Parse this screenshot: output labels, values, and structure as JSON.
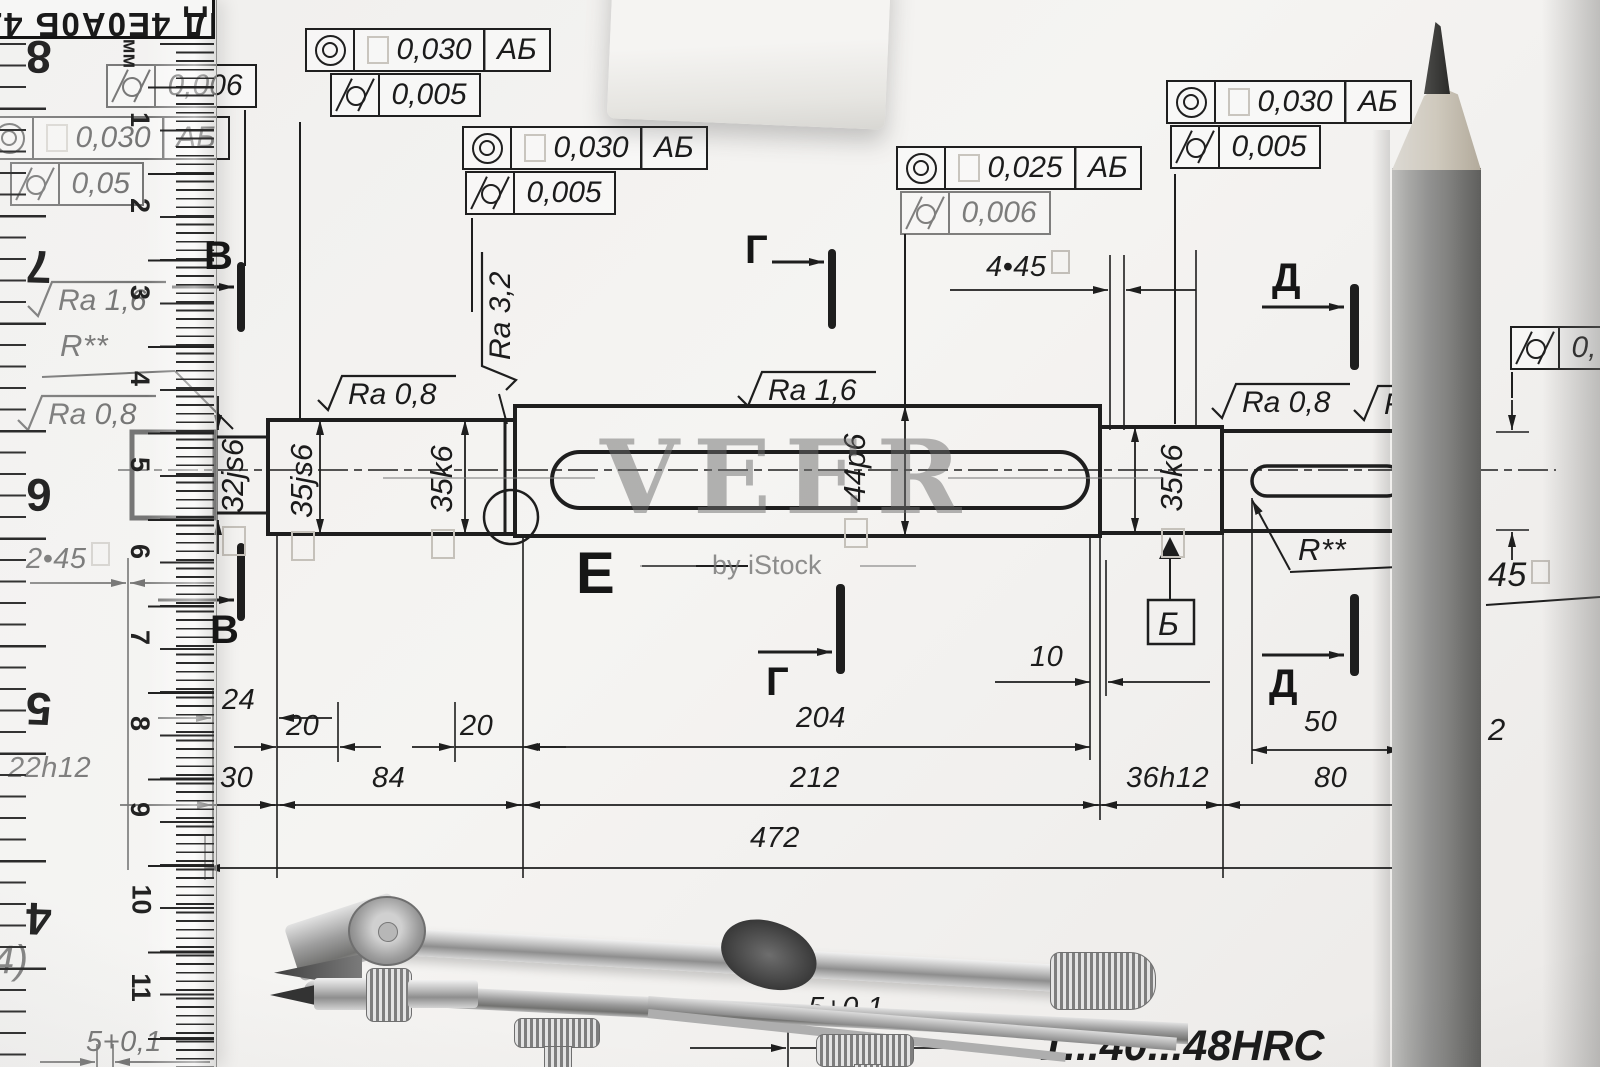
{
  "watermark": {
    "title": "VEER",
    "subtitle": "by iStock"
  },
  "header_plate": {
    "text": "ПД 4Е0А0Б 4Z"
  },
  "frames": {
    "ruler_top": {
      "value": "0,006"
    },
    "under_ruler": {
      "row1": {
        "value": "0,030",
        "datum": "АБ"
      },
      "row2": {
        "value": "0,05"
      }
    },
    "top": {
      "row1": {
        "value": "0,030",
        "datum": "АБ"
      },
      "row2": {
        "value": "0,005"
      }
    },
    "mid": {
      "row1": {
        "value": "0,030",
        "datum": "АБ"
      },
      "row2": {
        "value": "0,005"
      }
    },
    "center": {
      "row1": {
        "value": "0,025",
        "datum": "АБ"
      },
      "row2": {
        "value": "0,006"
      }
    },
    "right": {
      "row1": {
        "value": "0,030",
        "datum": "АБ"
      },
      "row2": {
        "value": "0,005"
      }
    },
    "edge": {
      "row2": {
        "value": "0,"
      }
    }
  },
  "surface_finish": {
    "left_ra16": "Ra 1,6",
    "left_r": "R**",
    "left_ra08": "Ra 0,8",
    "sec1_ra08": "Ra 0,8",
    "groove_ra32": "Ra 3,2",
    "mid_ra16": "Ra 1,6",
    "right_ra08": "Ra 0,8",
    "right_r_partial": "R",
    "key2_r": "R**"
  },
  "diameters": {
    "stub": "32js6",
    "sec1a": "35js6",
    "sec1b": "35k6",
    "mid": "44p6",
    "sec3": "35k6"
  },
  "sections": {
    "v": "В",
    "g": "Г",
    "d": "Д",
    "b": "Б",
    "e": "Е"
  },
  "chamfers": {
    "left": "2•45",
    "mid": "4•45",
    "right": "45"
  },
  "dimensions": {
    "w24": "24",
    "w20a": "20",
    "w20b": "20",
    "w204": "204",
    "w10": "10",
    "w50": "50",
    "w30": "30",
    "w84": "84",
    "w212": "212",
    "w36h12": "36h12",
    "w80": "80",
    "w472": "472",
    "key_depth": "5+0,1",
    "key_depth_left": "5+0,1",
    "left_margin": "22h12",
    "corner": "4)",
    "edge_right": "2"
  },
  "ruler": {
    "unit": "мм",
    "cm_numbers": [
      "1",
      "2",
      "3",
      "4",
      "5",
      "6",
      "7",
      "8",
      "9",
      "10",
      "11"
    ],
    "left_numbers": [
      "8",
      "7",
      "6",
      "5",
      "4"
    ]
  },
  "bottom_note": "1...40...48HRC"
}
